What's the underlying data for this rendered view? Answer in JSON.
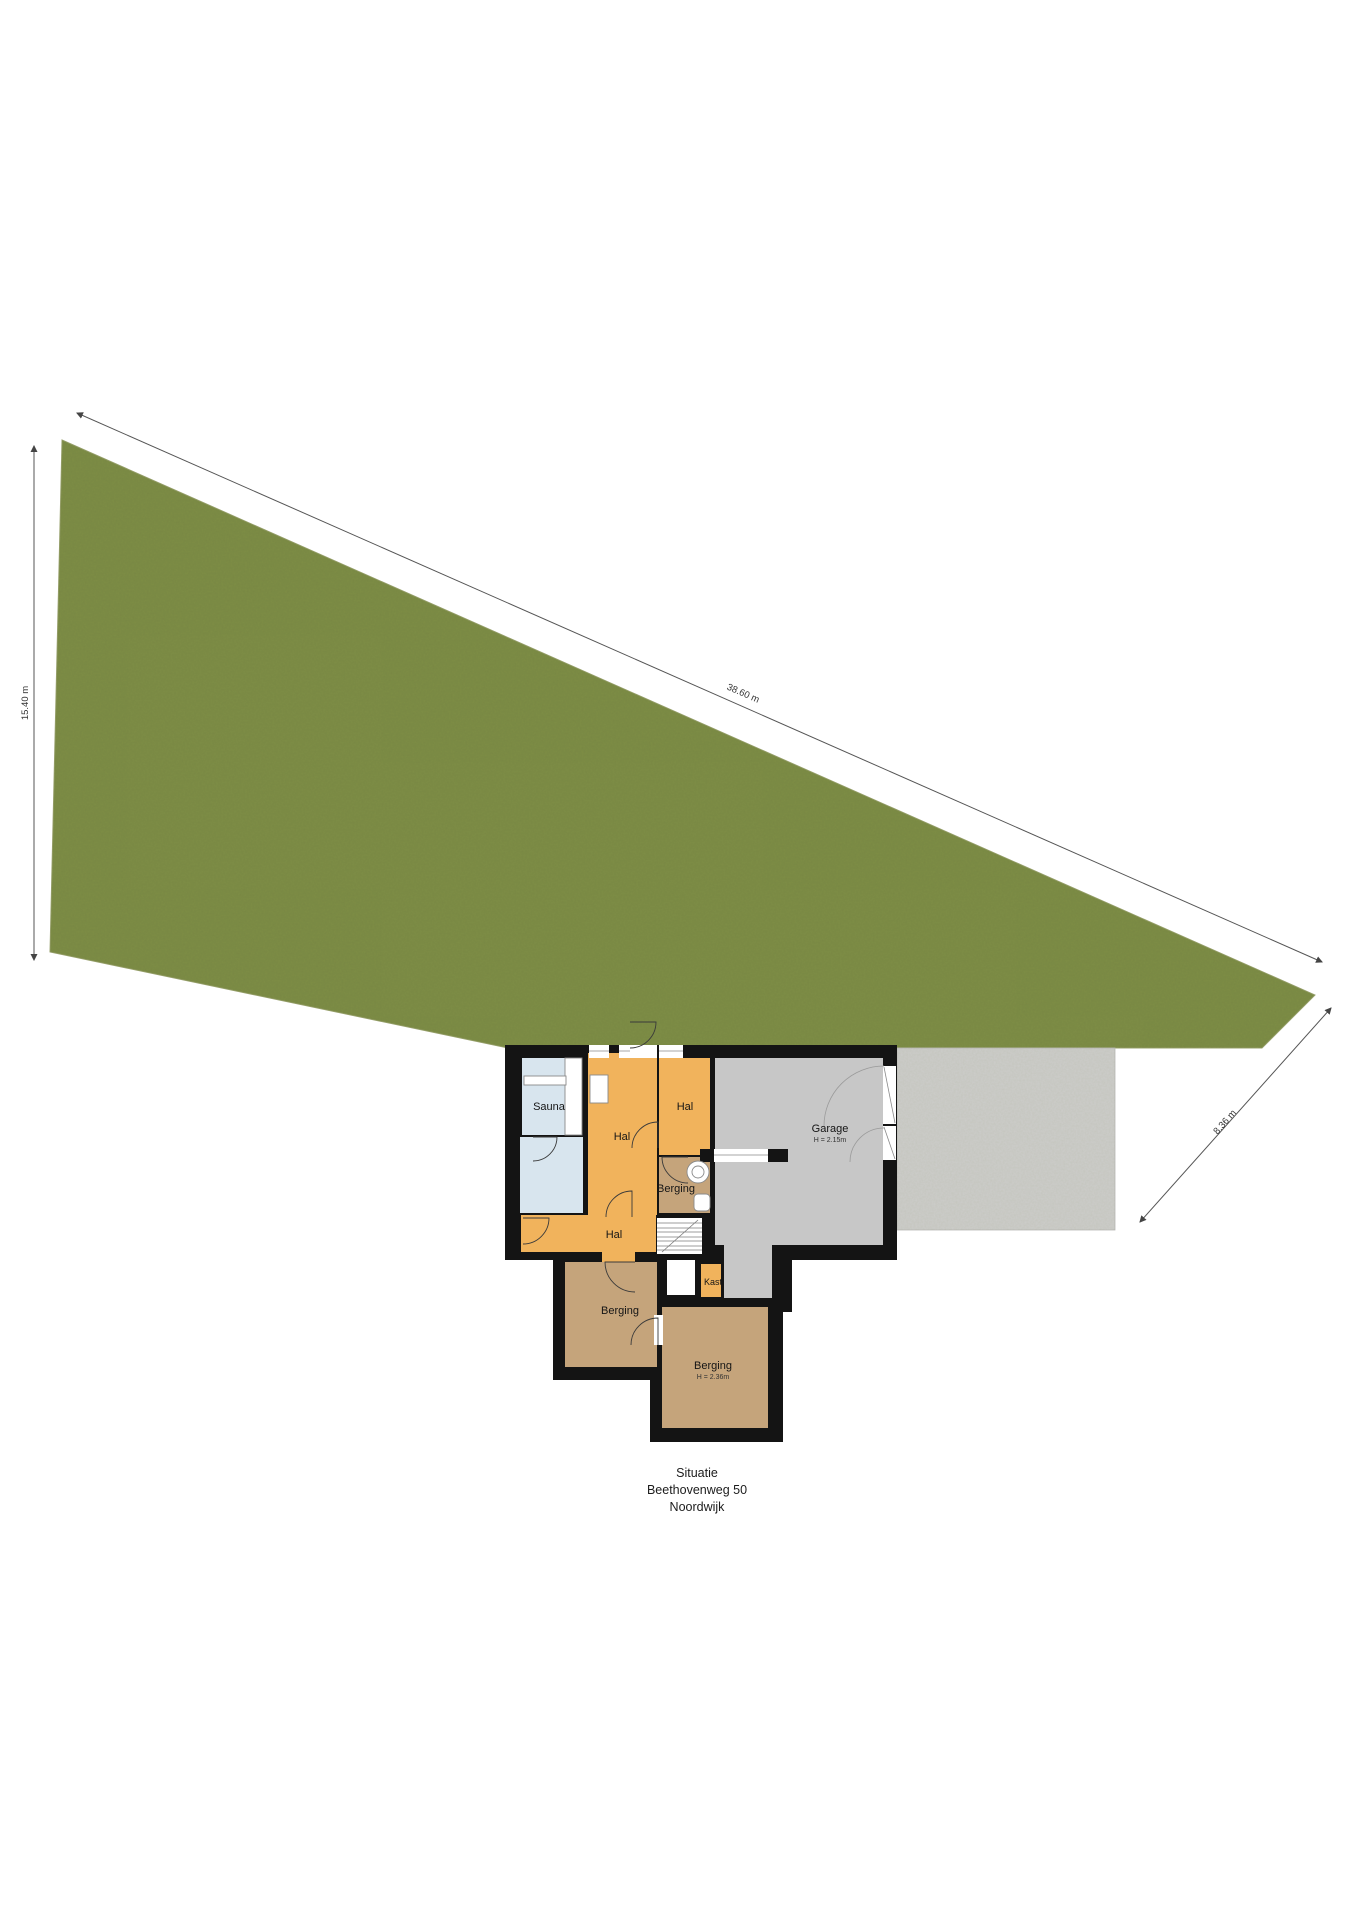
{
  "title": [
    "Situatie",
    "Beethovenweg 50",
    "Noordwijk"
  ],
  "dimensions": {
    "left": "15.40 m",
    "top": "38.60 m",
    "right": "8.36 m"
  },
  "rooms": {
    "sauna": {
      "label": "Sauna"
    },
    "hal_main": {
      "label": "Hal"
    },
    "hal_top": {
      "label": "Hal"
    },
    "berging_small": {
      "label": "Berging"
    },
    "garage": {
      "label": "Garage",
      "height": "H = 2.15m"
    },
    "hal_bottom": {
      "label": "Hal"
    },
    "kast": {
      "label": "Kast"
    },
    "berging_left": {
      "label": "Berging"
    },
    "berging_bottom": {
      "label": "Berging",
      "height": "H = 2.36m"
    }
  },
  "colors": {
    "grass": "#7e8e46",
    "paving": "#cdcdcb",
    "garage_floor": "#c7c7c7",
    "hal_floor": "#f1b35c",
    "berging_floor": "#c5a47b",
    "sauna_floor": "#d8e5ee",
    "wall": "#141414",
    "dimension_line": "#555555"
  }
}
